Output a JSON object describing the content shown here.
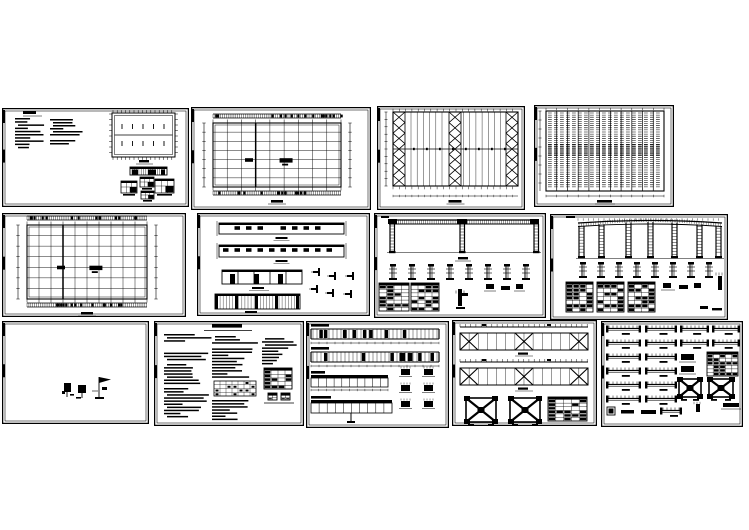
{
  "page": {
    "background": "#ffffff",
    "paper": "#ffffff",
    "ink": "#000000",
    "description": "Collage of 13 CAD structural drawing sheets for a steel portal-frame workshop, arranged in three rows on a white background"
  },
  "sheets": [
    {
      "id": "A",
      "name": "sheet-plan-with-notes",
      "kind": "notes_plan",
      "rect": {
        "x": 2,
        "y": 108,
        "w": 187,
        "h": 99
      },
      "params": {
        "note_blocks": 2,
        "inner_tick_rows": 2,
        "detail_boxes": 4
      }
    },
    {
      "id": "B",
      "name": "sheet-column-grid-plan",
      "kind": "grid_plan",
      "rect": {
        "x": 191,
        "y": 107,
        "w": 180,
        "h": 103
      },
      "params": {
        "cols": 9,
        "rows": 7,
        "heavy_col": 3,
        "labels": 2
      }
    },
    {
      "id": "C",
      "name": "sheet-roof-bracing-plan",
      "kind": "bracing_plan",
      "rect": {
        "x": 377,
        "y": 106,
        "w": 148,
        "h": 104
      },
      "params": {
        "braced_strips": 3,
        "x_per_strip": 7,
        "purlin_lines": 6
      }
    },
    {
      "id": "D",
      "name": "sheet-purlin-layout-plan",
      "kind": "purlin_plan",
      "rect": {
        "x": 534,
        "y": 105,
        "w": 140,
        "h": 102
      },
      "params": {
        "column_lines": 12,
        "dash_rows": 36
      }
    },
    {
      "id": "E",
      "name": "sheet-foundation-grid-plan",
      "kind": "grid_plan",
      "rect": {
        "x": 2,
        "y": 213,
        "w": 184,
        "h": 104
      },
      "params": {
        "cols": 10,
        "rows": 7,
        "heavy_col": 3,
        "labels": 2
      }
    },
    {
      "id": "F",
      "name": "sheet-wall-elevations",
      "kind": "elevations",
      "rect": {
        "x": 197,
        "y": 213,
        "w": 173,
        "h": 103
      },
      "params": {
        "strips": 4,
        "windows_per_strip": 10
      }
    },
    {
      "id": "G",
      "name": "sheet-portal-frame-elevation",
      "kind": "portal_frame",
      "rect": {
        "x": 374,
        "y": 213,
        "w": 172,
        "h": 105
      },
      "params": {
        "lattice_columns": 3,
        "base_details": 8,
        "schedule_tables": 2
      }
    },
    {
      "id": "H",
      "name": "sheet-gable-framing-elevation",
      "kind": "gable_frame",
      "rect": {
        "x": 550,
        "y": 214,
        "w": 178,
        "h": 106
      },
      "params": {
        "lattice_columns": 7,
        "base_details": 8,
        "schedule_tables": 3
      }
    },
    {
      "id": "I",
      "name": "sheet-sparse-details",
      "kind": "blank_marks",
      "rect": {
        "x": 2,
        "y": 321,
        "w": 147,
        "h": 103
      },
      "params": {
        "marks": 3
      }
    },
    {
      "id": "J",
      "name": "sheet-general-notes",
      "kind": "notes_text",
      "rect": {
        "x": 154,
        "y": 321,
        "w": 150,
        "h": 105
      },
      "params": {
        "text_columns": 3,
        "tables": 2
      }
    },
    {
      "id": "K",
      "name": "sheet-girt-elevations",
      "kind": "girt_elevations",
      "rect": {
        "x": 306,
        "y": 321,
        "w": 143,
        "h": 107
      },
      "params": {
        "strips": 4,
        "detail_glyphs": 6
      }
    },
    {
      "id": "L",
      "name": "sheet-roof-bracing-details",
      "kind": "bracing_elev",
      "rect": {
        "x": 452,
        "y": 320,
        "w": 145,
        "h": 106
      },
      "params": {
        "x_strips": 2,
        "big_x_details": 2,
        "tables": 1
      }
    },
    {
      "id": "M",
      "name": "sheet-connection-details",
      "kind": "details_sheet",
      "rect": {
        "x": 601,
        "y": 321,
        "w": 142,
        "h": 106
      },
      "params": {
        "beam_detail_rows": 6,
        "x_details": 2,
        "tables": 1
      }
    }
  ]
}
